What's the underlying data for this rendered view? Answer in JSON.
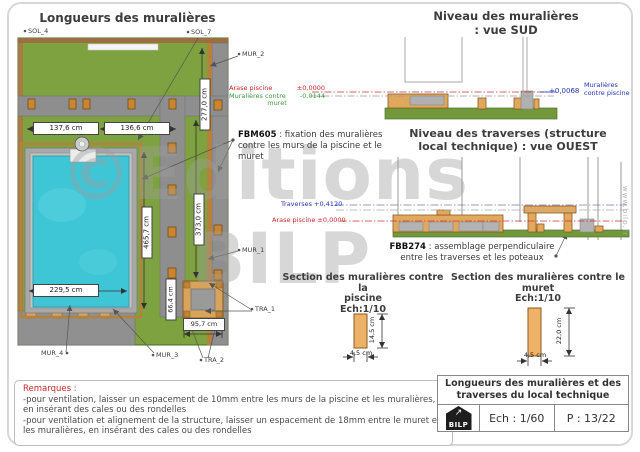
{
  "plan": {
    "title": "Longueurs des muralières",
    "dims": {
      "top_left": "137,6 cm",
      "top_right": "136,6 cm",
      "right_upper": "277,0 cm",
      "pool_length": "465,7 cm",
      "wall_length": "373,0 cm",
      "pool_width": "229,5 cm",
      "local_height": "66,4 cm",
      "local_width": "95,7 cm"
    },
    "refs": {
      "sol4": "SOL_4",
      "sol7": "SOL_7",
      "mur1": "MUR_1",
      "mur2": "MUR_2",
      "mur3": "MUR_3",
      "mur4": "MUR_4",
      "tra1": "TRA_1",
      "tra2": "TRA_2"
    }
  },
  "vue_sud": {
    "title1": "Niveau des muralières",
    "title2": ": vue SUD"
  },
  "vue_ouest": {
    "title1": "Niveau des traverses (structure",
    "title2": "local technique) : vue OUEST"
  },
  "levels": {
    "arase_label": "Arase piscine",
    "arase_value": "±0,0000",
    "muret_label_1": "Muralières contre",
    "muret_label_2": "muret",
    "muret_value": "-0,0144",
    "piscine_value": "+0,0068",
    "piscine_label_1": "Muralières",
    "piscine_label_2": "contre piscine",
    "traverses_label": "Traverses +0,4120",
    "arase_ouest": "Arase piscine ±0,0000"
  },
  "callouts": {
    "fbm605": {
      "code": "FBM605",
      "text": " : fixation des muralières contre les murs de la piscine et le muret"
    },
    "fbb274": {
      "code": "FBB274",
      "text": " : assemblage perpendiculaire",
      "text2": "entre les traverses et les poteaux"
    }
  },
  "sections": {
    "piscine": {
      "title1": "Section des muralières contre la",
      "title2": "piscine",
      "scale": "Ech:1/10",
      "h": "14,5 cm",
      "w": "4,5 cm"
    },
    "muret": {
      "title1": "Section des muralières contre le",
      "title2": "muret",
      "scale": "Ech:1/10",
      "h": "22,0 cm",
      "w": "4,5 cm"
    }
  },
  "remarks": {
    "heading": "Remarques :",
    "line1": "-pour ventilation, laisser un espacement de 10mm entre les murs de la piscine et les muralières, en insérant des cales ou des rondelles",
    "line2": "-pour ventilation et alignement de la structure, laisser un espacement de 18mm entre le muret et les muralières, en insérant des cales ou des rondelles"
  },
  "title_block": {
    "title1": "Longueurs des muralières et des",
    "title2": "traverses du local technique",
    "logo": "BILP",
    "scale": "Ech : 1/60",
    "page": "P : 13/22"
  },
  "watermark": {
    "big1": "©Editions",
    "big2": "BILP",
    "site": "www.bilp.fr"
  },
  "colors": {
    "lawn": "#7da23f",
    "path_gray": "#8e8e8e",
    "water": "#3ec6d6",
    "wood": "#d8a45c",
    "fixing_orange": "#c9852f",
    "level_red": "#cc2626",
    "level_green": "#3a9a3a",
    "level_blue": "#2233bb"
  }
}
